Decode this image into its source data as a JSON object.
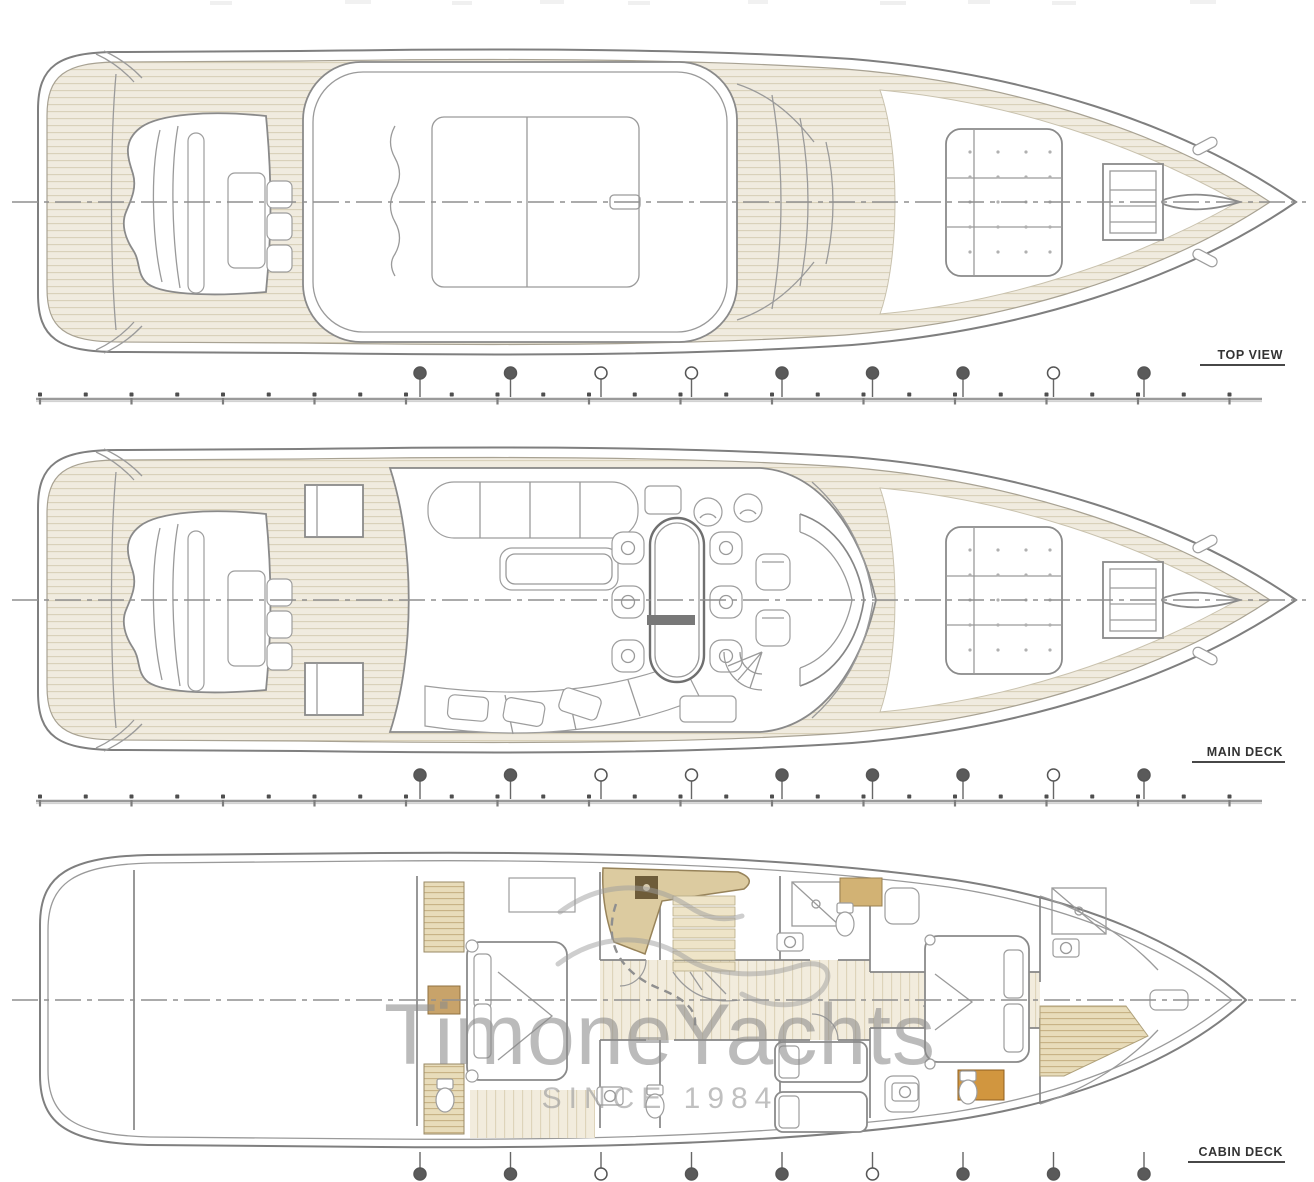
{
  "views": {
    "top": {
      "label": "TOP VIEW"
    },
    "main": {
      "label": "MAIN DECK"
    },
    "cabin": {
      "label": "CABIN DECK"
    }
  },
  "watermark": {
    "brand": "TimoneYachts",
    "tagline": "SINCE 1984"
  },
  "colors": {
    "drawing_line": "#8a8a8a",
    "teak_fill": "#f0ebdf",
    "teak_stripe": "#d8d0b8",
    "tan_counter": "#dccba0",
    "tan_cabinet": "#c8a36a",
    "orange_cabinet": "#d1963f",
    "watermark_gray": "#8b8b8b",
    "label_color": "#333333"
  }
}
